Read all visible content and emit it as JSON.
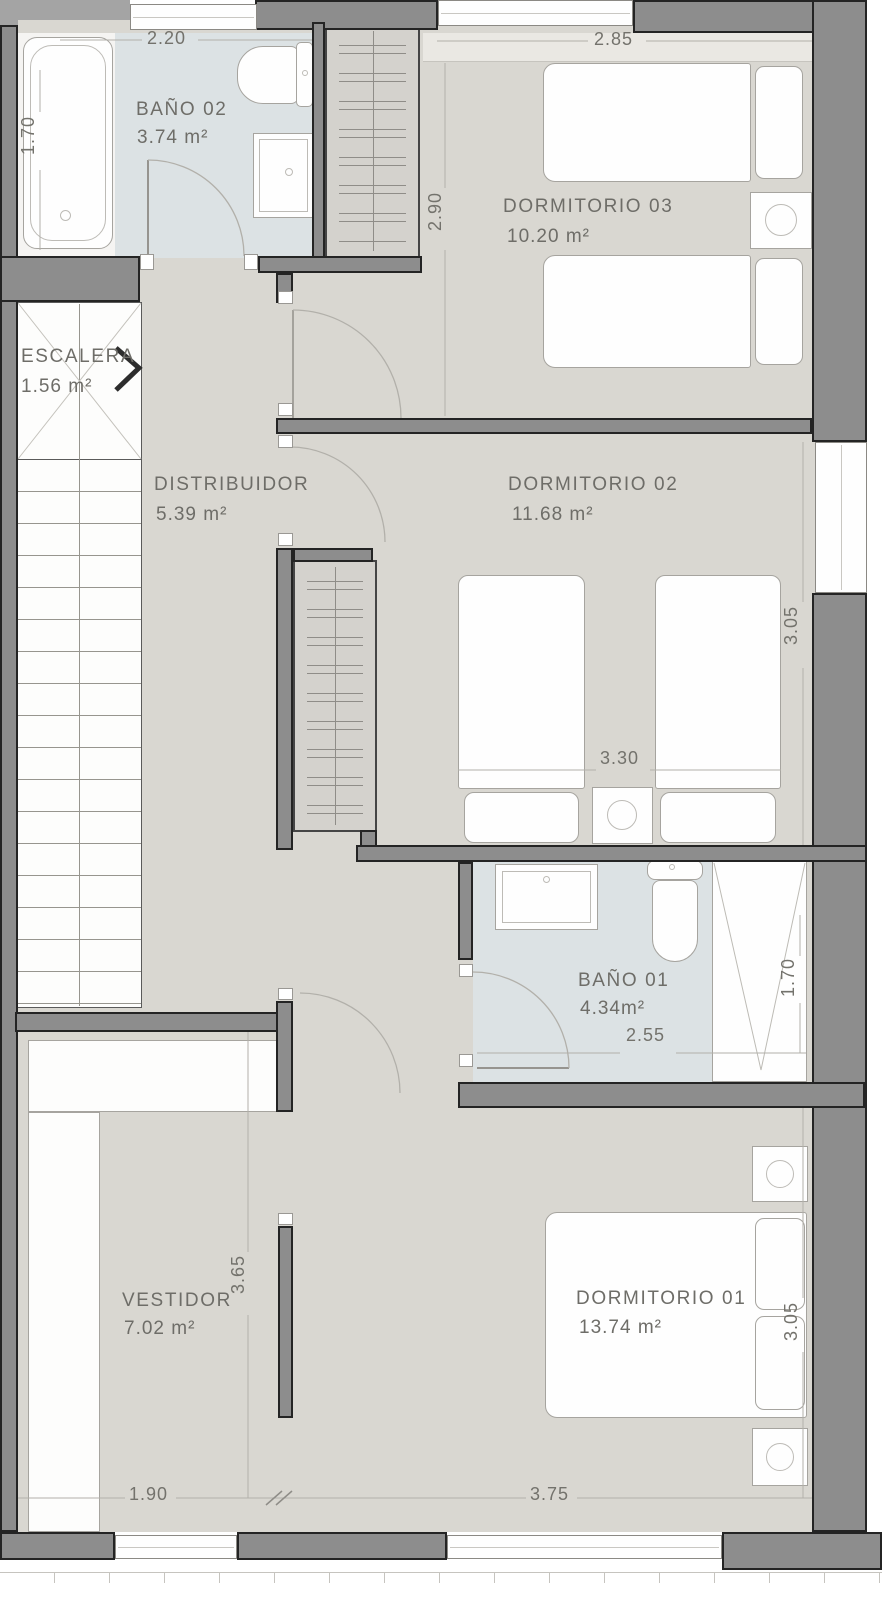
{
  "rooms": {
    "bano02": {
      "name": "BAÑO 02",
      "area": "3.74 m²"
    },
    "dorm03": {
      "name": "DORMITORIO 03",
      "area": "10.20 m²"
    },
    "escalera": {
      "name": "ESCALERA",
      "area": "1.56 m²"
    },
    "distribuidor": {
      "name": "DISTRIBUIDOR",
      "area": "5.39 m²"
    },
    "dorm02": {
      "name": "DORMITORIO 02",
      "area": "11.68 m²"
    },
    "bano01": {
      "name": "BAÑO 01",
      "area": "4.34m²"
    },
    "vestidor": {
      "name": "VESTIDOR",
      "area": "7.02 m²"
    },
    "dorm01": {
      "name": "DORMITORIO 01",
      "area": "13.74 m²"
    }
  },
  "dims": {
    "d220": "2.20",
    "d170_bano02": "1.70",
    "d285": "2.85",
    "d290": "2.90",
    "d330": "3.30",
    "d305_dorm02": "3.05",
    "d255": "2.55",
    "d170_bano01": "1.70",
    "d365": "3.65",
    "d190": "1.90",
    "d375": "3.75",
    "d305_dorm01": "3.05"
  },
  "colors": {
    "wall": "#8d8d8d",
    "floor": "#d9d7d1",
    "bathroom": "#dce2e4",
    "text": "#6e6d68"
  }
}
